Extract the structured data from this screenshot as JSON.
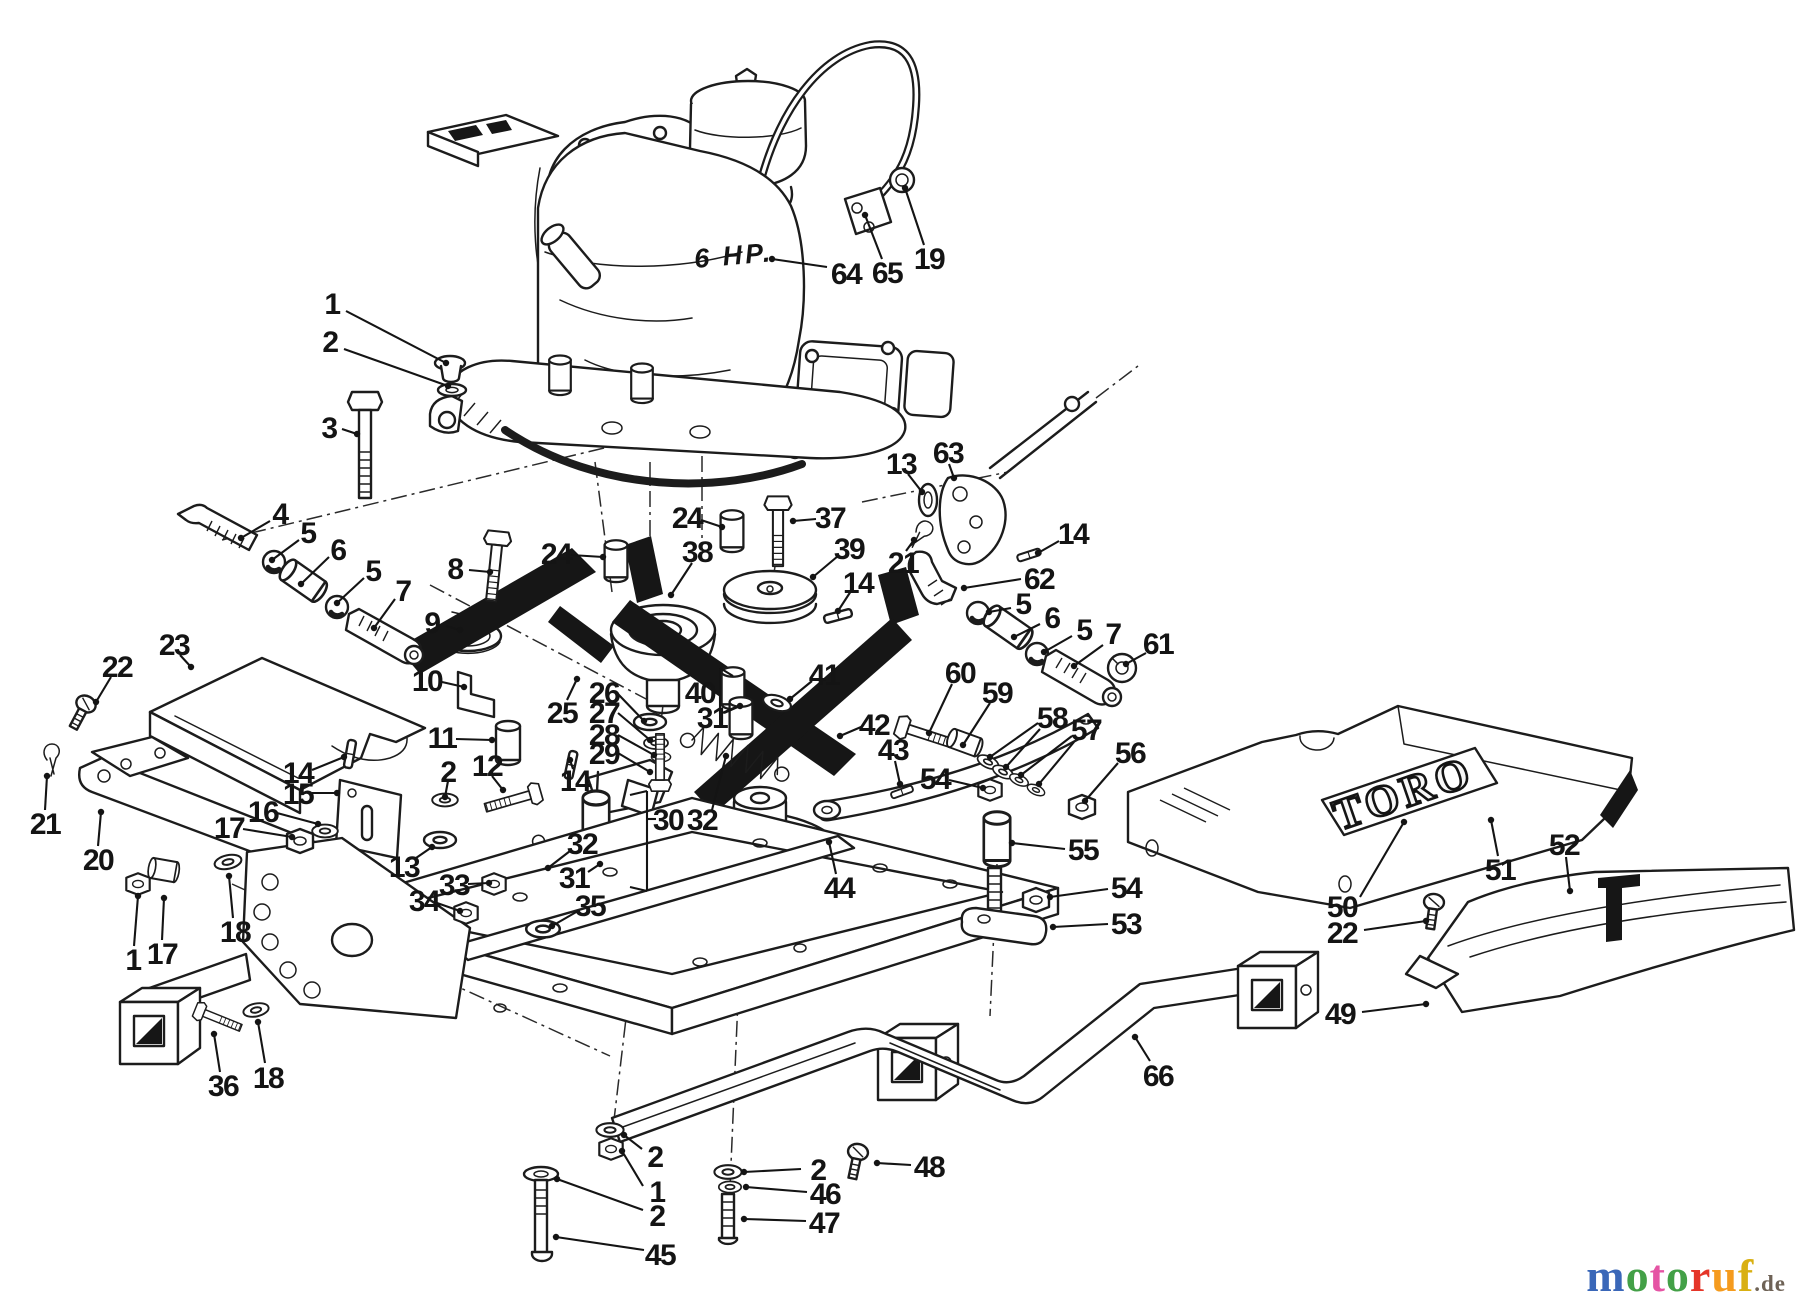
{
  "diagram": {
    "engine_power_label": "6 HP.",
    "brand_label": "TORO"
  },
  "watermark": {
    "letters": [
      [
        "m",
        "#3a67b8"
      ],
      [
        "o",
        "#43a047"
      ],
      [
        "t",
        "#e554a4"
      ],
      [
        "o",
        "#43a047"
      ],
      [
        "r",
        "#e53528"
      ],
      [
        "u",
        "#f59b1e"
      ],
      [
        "f",
        "#d9b012"
      ]
    ],
    "suffix": ".de",
    "suffix_color": "#6e6256"
  },
  "callouts": [
    {
      "n": "64",
      "x": 846,
      "y": 273,
      "l": [
        [
          827,
          267,
          772,
          259
        ]
      ]
    },
    {
      "n": "65",
      "x": 887,
      "y": 272,
      "l": [
        [
          882,
          259,
          865,
          215
        ]
      ]
    },
    {
      "n": "19",
      "x": 929,
      "y": 258,
      "l": [
        [
          924,
          245,
          905,
          188
        ]
      ]
    },
    {
      "n": "1",
      "x": 332,
      "y": 303,
      "l": [
        [
          346,
          311,
          446,
          363
        ]
      ]
    },
    {
      "n": "2",
      "x": 330,
      "y": 341,
      "l": [
        [
          344,
          349,
          448,
          386
        ]
      ]
    },
    {
      "n": "3",
      "x": 329,
      "y": 427,
      "l": [
        [
          342,
          429,
          357,
          434
        ]
      ]
    },
    {
      "n": "4",
      "x": 280,
      "y": 513,
      "l": [
        [
          270,
          521,
          241,
          538
        ]
      ]
    },
    {
      "n": "5",
      "x": 308,
      "y": 532,
      "l": [
        [
          299,
          540,
          272,
          560
        ]
      ]
    },
    {
      "n": "6",
      "x": 338,
      "y": 549,
      "l": [
        [
          329,
          557,
          301,
          584
        ]
      ]
    },
    {
      "n": "5",
      "x": 373,
      "y": 570,
      "l": [
        [
          364,
          578,
          337,
          603
        ]
      ]
    },
    {
      "n": "7",
      "x": 403,
      "y": 590,
      "l": [
        [
          395,
          599,
          374,
          628
        ]
      ]
    },
    {
      "n": "8",
      "x": 455,
      "y": 568,
      "l": [
        [
          469,
          570,
          490,
          572
        ]
      ]
    },
    {
      "n": "9",
      "x": 432,
      "y": 622,
      "l": [
        [
          446,
          626,
          460,
          630
        ]
      ]
    },
    {
      "n": "10",
      "x": 427,
      "y": 680,
      "l": [
        [
          442,
          682,
          464,
          687
        ]
      ]
    },
    {
      "n": "11",
      "x": 442,
      "y": 737,
      "l": [
        [
          456,
          739,
          492,
          740
        ]
      ]
    },
    {
      "n": "12",
      "x": 487,
      "y": 765,
      "l": [
        [
          492,
          776,
          503,
          790
        ]
      ]
    },
    {
      "n": "2",
      "x": 448,
      "y": 771,
      "l": [
        [
          448,
          781,
          445,
          797
        ]
      ]
    },
    {
      "n": "14",
      "x": 575,
      "y": 780,
      "l": [
        [
          573,
          769,
          570,
          760
        ]
      ]
    },
    {
      "n": "13",
      "x": 404,
      "y": 866,
      "l": [
        [
          416,
          858,
          432,
          847
        ]
      ]
    },
    {
      "n": "33",
      "x": 454,
      "y": 884,
      "l": [
        [
          468,
          884,
          489,
          883
        ]
      ]
    },
    {
      "n": "34",
      "x": 424,
      "y": 900,
      "l": [
        [
          437,
          903,
          460,
          911
        ]
      ]
    },
    {
      "n": "35",
      "x": 590,
      "y": 905,
      "l": [
        [
          578,
          911,
          552,
          926
        ]
      ]
    },
    {
      "n": "25",
      "x": 562,
      "y": 712,
      "l": [
        [
          567,
          700,
          577,
          679
        ]
      ]
    },
    {
      "n": "26",
      "x": 604,
      "y": 692,
      "l": [
        [
          618,
          694,
          644,
          721
        ]
      ]
    },
    {
      "n": "27",
      "x": 604,
      "y": 712,
      "l": [
        [
          618,
          713,
          650,
          740
        ]
      ]
    },
    {
      "n": "28",
      "x": 604,
      "y": 734,
      "l": [
        [
          618,
          735,
          654,
          755
        ]
      ]
    },
    {
      "n": "29",
      "x": 604,
      "y": 753,
      "l": [
        [
          618,
          753,
          650,
          772
        ]
      ]
    },
    {
      "n": "30",
      "x": 668,
      "y": 819,
      "nd": true,
      "l": [
        [
          656,
          819,
          647,
          819
        ],
        [
          647,
          791,
          647,
          891
        ],
        [
          647,
          791,
          630,
          795
        ],
        [
          647,
          891,
          630,
          887
        ]
      ]
    },
    {
      "n": "31",
      "x": 574,
      "y": 877,
      "l": [
        [
          588,
          872,
          600,
          864
        ]
      ]
    },
    {
      "n": "32",
      "x": 582,
      "y": 843,
      "l": [
        [
          570,
          851,
          548,
          868
        ]
      ]
    },
    {
      "n": "40",
      "x": 700,
      "y": 692,
      "nd": true,
      "l": [
        [
          712,
          692,
          720,
          692
        ],
        [
          720,
          668,
          720,
          714
        ],
        [
          720,
          668,
          733,
          676
        ],
        [
          720,
          714,
          736,
          707
        ]
      ]
    },
    {
      "n": "31",
      "x": 712,
      "y": 717,
      "l": [
        [
          724,
          713,
          740,
          706
        ]
      ]
    },
    {
      "n": "41",
      "x": 824,
      "y": 674,
      "l": [
        [
          812,
          681,
          790,
          699
        ]
      ]
    },
    {
      "n": "42",
      "x": 874,
      "y": 724,
      "l": [
        [
          861,
          727,
          840,
          736
        ]
      ]
    },
    {
      "n": "43",
      "x": 893,
      "y": 749,
      "l": [
        [
          895,
          761,
          900,
          784
        ]
      ]
    },
    {
      "n": "44",
      "x": 839,
      "y": 887,
      "l": [
        [
          836,
          874,
          829,
          842
        ]
      ]
    },
    {
      "n": "60",
      "x": 960,
      "y": 672,
      "l": [
        [
          952,
          684,
          929,
          733
        ]
      ]
    },
    {
      "n": "59",
      "x": 997,
      "y": 692,
      "l": [
        [
          990,
          703,
          963,
          745
        ]
      ]
    },
    {
      "n": "58",
      "x": 1052,
      "y": 717,
      "l": [
        [
          1038,
          723,
          990,
          757
        ],
        [
          1040,
          729,
          1006,
          767
        ]
      ]
    },
    {
      "n": "57",
      "x": 1086,
      "y": 729,
      "l": [
        [
          1072,
          736,
          1021,
          775
        ],
        [
          1074,
          742,
          1039,
          784
        ]
      ]
    },
    {
      "n": "56",
      "x": 1130,
      "y": 752,
      "l": [
        [
          1118,
          763,
          1085,
          801
        ]
      ]
    },
    {
      "n": "54",
      "x": 935,
      "y": 778,
      "l": [
        [
          949,
          780,
          983,
          788
        ]
      ]
    },
    {
      "n": "55",
      "x": 1083,
      "y": 849,
      "l": [
        [
          1065,
          849,
          1012,
          843
        ]
      ]
    },
    {
      "n": "54",
      "x": 1126,
      "y": 887,
      "l": [
        [
          1108,
          889,
          1050,
          897
        ]
      ]
    },
    {
      "n": "53",
      "x": 1126,
      "y": 923,
      "l": [
        [
          1108,
          924,
          1053,
          927
        ]
      ]
    },
    {
      "n": "61",
      "x": 1158,
      "y": 643,
      "l": [
        [
          1146,
          653,
          1126,
          664
        ]
      ]
    },
    {
      "n": "13",
      "x": 901,
      "y": 463,
      "l": [
        [
          908,
          474,
          922,
          492
        ]
      ]
    },
    {
      "n": "63",
      "x": 948,
      "y": 452,
      "l": [
        [
          949,
          464,
          954,
          478
        ]
      ]
    },
    {
      "n": "21",
      "x": 903,
      "y": 562,
      "l": [
        [
          906,
          551,
          914,
          540
        ]
      ]
    },
    {
      "n": "62",
      "x": 1039,
      "y": 578,
      "l": [
        [
          1021,
          579,
          964,
          588
        ]
      ]
    },
    {
      "n": "14",
      "x": 1073,
      "y": 533,
      "l": [
        [
          1059,
          541,
          1038,
          553
        ]
      ]
    },
    {
      "n": "5",
      "x": 1023,
      "y": 603,
      "l": [
        [
          1011,
          608,
          989,
          612
        ]
      ]
    },
    {
      "n": "6",
      "x": 1052,
      "y": 617,
      "l": [
        [
          1040,
          624,
          1014,
          637
        ]
      ]
    },
    {
      "n": "5",
      "x": 1084,
      "y": 629,
      "l": [
        [
          1072,
          636,
          1044,
          652
        ]
      ]
    },
    {
      "n": "7",
      "x": 1113,
      "y": 633,
      "l": [
        [
          1103,
          645,
          1074,
          666
        ]
      ]
    },
    {
      "n": "37",
      "x": 830,
      "y": 517,
      "l": [
        [
          816,
          519,
          793,
          521
        ]
      ]
    },
    {
      "n": "39",
      "x": 849,
      "y": 548,
      "l": [
        [
          838,
          556,
          813,
          577
        ]
      ]
    },
    {
      "n": "14",
      "x": 858,
      "y": 582,
      "l": [
        [
          851,
          591,
          838,
          611
        ]
      ]
    },
    {
      "n": "24",
      "x": 556,
      "y": 553,
      "l": [
        [
          571,
          555,
          603,
          557
        ]
      ]
    },
    {
      "n": "24",
      "x": 687,
      "y": 517,
      "l": [
        [
          701,
          520,
          722,
          527
        ]
      ]
    },
    {
      "n": "38",
      "x": 697,
      "y": 551,
      "l": [
        [
          692,
          563,
          671,
          595
        ]
      ]
    },
    {
      "n": "36",
      "x": 223,
      "y": 1085,
      "l": [
        [
          220,
          1072,
          214,
          1034
        ]
      ]
    },
    {
      "n": "18",
      "x": 268,
      "y": 1077,
      "l": [
        [
          265,
          1063,
          258,
          1022
        ]
      ]
    },
    {
      "n": "66",
      "x": 1158,
      "y": 1075,
      "l": [
        [
          1150,
          1061,
          1135,
          1037
        ]
      ]
    },
    {
      "n": "49",
      "x": 1340,
      "y": 1013,
      "l": [
        [
          1362,
          1012,
          1426,
          1004
        ]
      ]
    },
    {
      "n": "50",
      "x": 1342,
      "y": 906,
      "l": [
        [
          1360,
          897,
          1404,
          822
        ]
      ]
    },
    {
      "n": "22",
      "x": 1342,
      "y": 932,
      "l": [
        [
          1364,
          930,
          1426,
          921
        ]
      ]
    },
    {
      "n": "51",
      "x": 1500,
      "y": 869,
      "l": [
        [
          1498,
          856,
          1491,
          820
        ]
      ]
    },
    {
      "n": "52",
      "x": 1564,
      "y": 844,
      "l": [
        [
          1566,
          857,
          1570,
          891
        ]
      ]
    },
    {
      "n": "45",
      "x": 660,
      "y": 1254,
      "l": [
        [
          644,
          1250,
          556,
          1237
        ]
      ]
    },
    {
      "n": "2",
      "x": 655,
      "y": 1156,
      "l": [
        [
          642,
          1149,
          624,
          1135
        ]
      ]
    },
    {
      "n": "1",
      "x": 657,
      "y": 1191,
      "l": [
        [
          643,
          1186,
          622,
          1151
        ]
      ]
    },
    {
      "n": "2",
      "x": 657,
      "y": 1215,
      "l": [
        [
          643,
          1210,
          557,
          1179
        ]
      ]
    },
    {
      "n": "2",
      "x": 818,
      "y": 1169,
      "l": [
        [
          801,
          1169,
          744,
          1172
        ]
      ]
    },
    {
      "n": "46",
      "x": 825,
      "y": 1193,
      "l": [
        [
          807,
          1192,
          746,
          1187
        ]
      ]
    },
    {
      "n": "47",
      "x": 824,
      "y": 1222,
      "l": [
        [
          806,
          1221,
          744,
          1219
        ]
      ]
    },
    {
      "n": "48",
      "x": 929,
      "y": 1166,
      "l": [
        [
          911,
          1165,
          877,
          1163
        ]
      ]
    },
    {
      "n": "23",
      "x": 174,
      "y": 644,
      "l": [
        [
          180,
          655,
          191,
          667
        ]
      ]
    },
    {
      "n": "22",
      "x": 117,
      "y": 666,
      "l": [
        [
          111,
          677,
          96,
          702
        ]
      ]
    },
    {
      "n": "21",
      "x": 45,
      "y": 823,
      "l": [
        [
          45,
          810,
          47,
          776
        ]
      ]
    },
    {
      "n": "20",
      "x": 98,
      "y": 859,
      "l": [
        [
          98,
          846,
          101,
          812
        ]
      ]
    },
    {
      "n": "1",
      "x": 133,
      "y": 959,
      "l": [
        [
          134,
          946,
          138,
          896
        ]
      ]
    },
    {
      "n": "17",
      "x": 162,
      "y": 953,
      "l": [
        [
          162,
          940,
          164,
          898
        ]
      ]
    },
    {
      "n": "18",
      "x": 235,
      "y": 931,
      "l": [
        [
          233,
          918,
          229,
          876
        ]
      ]
    },
    {
      "n": "14",
      "x": 298,
      "y": 772,
      "l": [
        [
          312,
          770,
          344,
          757
        ]
      ]
    },
    {
      "n": "15",
      "x": 298,
      "y": 793,
      "l": [
        [
          312,
          793,
          337,
          793
        ]
      ]
    },
    {
      "n": "16",
      "x": 263,
      "y": 811,
      "l": [
        [
          277,
          813,
          318,
          824
        ]
      ]
    },
    {
      "n": "17",
      "x": 229,
      "y": 827,
      "l": [
        [
          243,
          829,
          292,
          837
        ]
      ]
    },
    {
      "n": "32",
      "x": 702,
      "y": 819,
      "l": [
        [
          712,
          810,
          726,
          756
        ]
      ]
    }
  ]
}
